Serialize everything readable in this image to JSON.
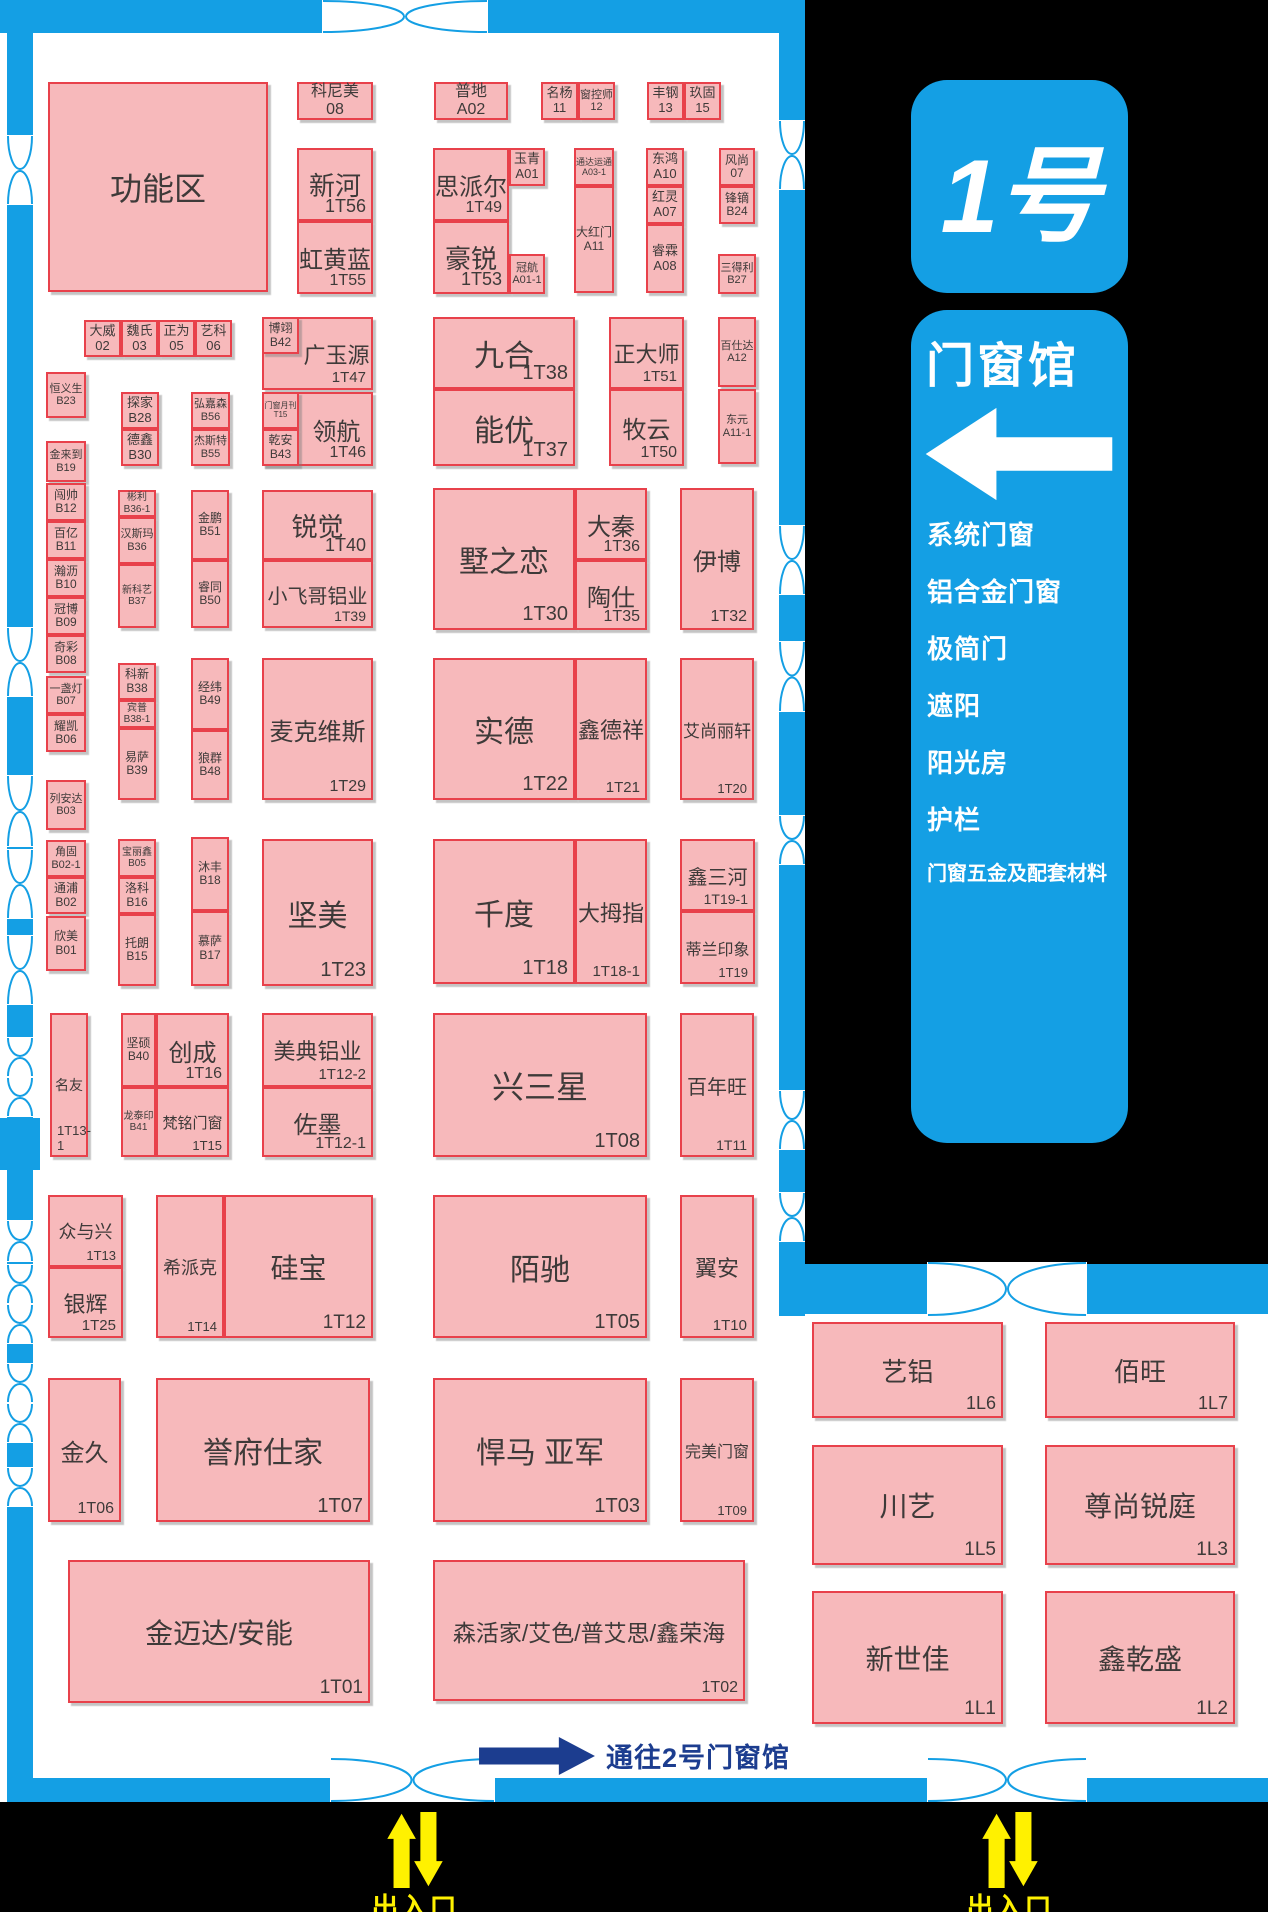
{
  "hall": {
    "badge": "1号",
    "name": "门窗馆"
  },
  "categories": [
    "系统门窗",
    "铝合金门窗",
    "极简门",
    "遮阳",
    "阳光房",
    "护栏",
    "门窗五金及配套材料"
  ],
  "signs": {
    "to_hall2": {
      "prefix": "通往",
      "number": "2",
      "suffix": "号门窗馆"
    },
    "entrance": "出入口"
  },
  "colors": {
    "wall": "#149FE4",
    "pink": "#F7B9BB",
    "red": "#E8414B",
    "dark": "#3E3A39",
    "navy": "#1C3D8F",
    "yellow": "#FFF100"
  },
  "booths": [
    {
      "n": "功能区",
      "no": "",
      "x": 48,
      "y": 82,
      "w": 220,
      "h": 210,
      "fs": 32,
      "m": "c"
    },
    {
      "n": "科尼美",
      "no": "08",
      "x": 297,
      "y": 82,
      "w": 76,
      "h": 38,
      "fs": 16,
      "m": "s"
    },
    {
      "n": "新河",
      "no": "1T56",
      "x": 297,
      "y": 148,
      "w": 76,
      "h": 73,
      "fs": 26,
      "m": "c"
    },
    {
      "n": "虹黄蓝",
      "no": "1T55",
      "x": 297,
      "y": 221,
      "w": 76,
      "h": 73,
      "fs": 24,
      "m": "c"
    },
    {
      "n": "普地",
      "no": "A02",
      "x": 434,
      "y": 82,
      "w": 74,
      "h": 38,
      "fs": 16,
      "m": "s"
    },
    {
      "n": "思派尔",
      "no": "1T49",
      "x": 433,
      "y": 148,
      "w": 76,
      "h": 73,
      "fs": 24,
      "m": "c"
    },
    {
      "n": "豪锐",
      "no": "1T53",
      "x": 433,
      "y": 221,
      "w": 76,
      "h": 73,
      "fs": 26,
      "m": "c"
    },
    {
      "n": "玉青",
      "no": "A01",
      "x": 509,
      "y": 148,
      "w": 36,
      "h": 38,
      "fs": 13,
      "m": "s"
    },
    {
      "n": "冠航",
      "no": "A01-1",
      "x": 509,
      "y": 254,
      "w": 36,
      "h": 40,
      "fs": 11,
      "m": "s"
    },
    {
      "n": "名杨",
      "no": "11",
      "x": 541,
      "y": 82,
      "w": 37,
      "h": 38,
      "fs": 13,
      "m": "s"
    },
    {
      "n": "窗控师",
      "no": "12",
      "x": 578,
      "y": 82,
      "w": 37,
      "h": 38,
      "fs": 11,
      "m": "s"
    },
    {
      "n": "通达运通",
      "no": "A03-1",
      "x": 574,
      "y": 148,
      "w": 40,
      "h": 38,
      "fs": 9,
      "m": "s"
    },
    {
      "n": "大红门",
      "no": "A11",
      "x": 574,
      "y": 186,
      "w": 40,
      "h": 107,
      "fs": 12,
      "m": "s"
    },
    {
      "n": "丰钢",
      "no": "13",
      "x": 647,
      "y": 82,
      "w": 37,
      "h": 38,
      "fs": 13,
      "m": "s"
    },
    {
      "n": "玖固",
      "no": "15",
      "x": 684,
      "y": 82,
      "w": 37,
      "h": 38,
      "fs": 13,
      "m": "s"
    },
    {
      "n": "东鸿",
      "no": "A10",
      "x": 646,
      "y": 148,
      "w": 38,
      "h": 38,
      "fs": 13,
      "m": "s"
    },
    {
      "n": "红灵",
      "no": "A07",
      "x": 646,
      "y": 186,
      "w": 38,
      "h": 38,
      "fs": 13,
      "m": "s"
    },
    {
      "n": "睿霖",
      "no": "A08",
      "x": 646,
      "y": 224,
      "w": 38,
      "h": 69,
      "fs": 13,
      "m": "s"
    },
    {
      "n": "风尚",
      "no": "07",
      "x": 719,
      "y": 148,
      "w": 36,
      "h": 38,
      "fs": 12,
      "m": "s"
    },
    {
      "n": "锋镝",
      "no": "B24",
      "x": 719,
      "y": 186,
      "w": 36,
      "h": 38,
      "fs": 12,
      "m": "s"
    },
    {
      "n": "三得利",
      "no": "B27",
      "x": 718,
      "y": 254,
      "w": 38,
      "h": 40,
      "fs": 11,
      "m": "s"
    },
    {
      "n": "大威",
      "no": "02",
      "x": 84,
      "y": 320,
      "w": 37,
      "h": 37,
      "fs": 13,
      "m": "s"
    },
    {
      "n": "魏氏",
      "no": "03",
      "x": 121,
      "y": 320,
      "w": 37,
      "h": 37,
      "fs": 13,
      "m": "s"
    },
    {
      "n": "正为",
      "no": "05",
      "x": 158,
      "y": 320,
      "w": 37,
      "h": 37,
      "fs": 13,
      "m": "s"
    },
    {
      "n": "艺科",
      "no": "06",
      "x": 195,
      "y": 320,
      "w": 37,
      "h": 37,
      "fs": 13,
      "m": "s"
    },
    {
      "n": "恒义生",
      "no": "B23",
      "x": 46,
      "y": 372,
      "w": 40,
      "h": 46,
      "fs": 11,
      "m": "s"
    },
    {
      "n": "探家",
      "no": "B28",
      "x": 121,
      "y": 392,
      "w": 38,
      "h": 37,
      "fs": 13,
      "m": "s"
    },
    {
      "n": "德鑫",
      "no": "B30",
      "x": 121,
      "y": 429,
      "w": 38,
      "h": 37,
      "fs": 13,
      "m": "s"
    },
    {
      "n": "弘嘉森",
      "no": "B56",
      "x": 191,
      "y": 392,
      "w": 39,
      "h": 37,
      "fs": 11,
      "m": "s"
    },
    {
      "n": "杰斯特",
      "no": "B55",
      "x": 191,
      "y": 429,
      "w": 39,
      "h": 37,
      "fs": 11,
      "m": "s"
    },
    {
      "n": "广玉源",
      "no": "1T47",
      "x": 262,
      "y": 317,
      "w": 111,
      "h": 73,
      "fs": 22,
      "m": "c",
      "pl": 38
    },
    {
      "n": "博翊",
      "no": "B42",
      "x": 262,
      "y": 317,
      "w": 37,
      "h": 37,
      "fs": 12,
      "m": "s"
    },
    {
      "n": "领航",
      "no": "1T46",
      "x": 262,
      "y": 392,
      "w": 111,
      "h": 74,
      "fs": 24,
      "m": "c",
      "pl": 38
    },
    {
      "n": "门窗月刊",
      "no": "T15",
      "x": 262,
      "y": 392,
      "w": 37,
      "h": 37,
      "fs": 8,
      "m": "s"
    },
    {
      "n": "乾安",
      "no": "B43",
      "x": 262,
      "y": 429,
      "w": 37,
      "h": 37,
      "fs": 12,
      "m": "s"
    },
    {
      "n": "九合",
      "no": "1T38",
      "x": 433,
      "y": 317,
      "w": 142,
      "h": 72,
      "fs": 30,
      "m": "c"
    },
    {
      "n": "能优",
      "no": "1T37",
      "x": 433,
      "y": 389,
      "w": 142,
      "h": 77,
      "fs": 30,
      "m": "c"
    },
    {
      "n": "正大师",
      "no": "1T51",
      "x": 609,
      "y": 317,
      "w": 75,
      "h": 72,
      "fs": 22,
      "m": "c"
    },
    {
      "n": "牧云",
      "no": "1T50",
      "x": 609,
      "y": 389,
      "w": 75,
      "h": 77,
      "fs": 24,
      "m": "c"
    },
    {
      "n": "百仕达",
      "no": "A12",
      "x": 718,
      "y": 317,
      "w": 38,
      "h": 70,
      "fs": 11,
      "m": "s"
    },
    {
      "n": "东元",
      "no": "A11-1",
      "x": 718,
      "y": 389,
      "w": 38,
      "h": 75,
      "fs": 11,
      "m": "s"
    },
    {
      "n": "金来到",
      "no": "B19",
      "x": 46,
      "y": 441,
      "w": 40,
      "h": 41,
      "fs": 11,
      "m": "s"
    },
    {
      "n": "闯帅",
      "no": "B12",
      "x": 46,
      "y": 483,
      "w": 40,
      "h": 38,
      "fs": 12,
      "m": "s"
    },
    {
      "n": "百亿",
      "no": "B11",
      "x": 46,
      "y": 521,
      "w": 40,
      "h": 38,
      "fs": 12,
      "m": "s"
    },
    {
      "n": "瀚沥",
      "no": "B10",
      "x": 46,
      "y": 559,
      "w": 40,
      "h": 38,
      "fs": 12,
      "m": "s"
    },
    {
      "n": "冠博",
      "no": "B09",
      "x": 46,
      "y": 597,
      "w": 40,
      "h": 38,
      "fs": 12,
      "m": "s"
    },
    {
      "n": "奇彩",
      "no": "B08",
      "x": 46,
      "y": 635,
      "w": 40,
      "h": 38,
      "fs": 12,
      "m": "s"
    },
    {
      "n": "一盏灯",
      "no": "B07",
      "x": 46,
      "y": 676,
      "w": 40,
      "h": 38,
      "fs": 11,
      "m": "s"
    },
    {
      "n": "耀凯",
      "no": "B06",
      "x": 46,
      "y": 714,
      "w": 40,
      "h": 38,
      "fs": 12,
      "m": "s"
    },
    {
      "n": "列安达",
      "no": "B03",
      "x": 46,
      "y": 780,
      "w": 40,
      "h": 50,
      "fs": 11,
      "m": "s"
    },
    {
      "n": "角固",
      "no": "B02-1",
      "x": 46,
      "y": 840,
      "w": 40,
      "h": 37,
      "fs": 11,
      "m": "s"
    },
    {
      "n": "通浦",
      "no": "B02",
      "x": 46,
      "y": 877,
      "w": 40,
      "h": 37,
      "fs": 12,
      "m": "s"
    },
    {
      "n": "欣美",
      "no": "B01",
      "x": 46,
      "y": 916,
      "w": 40,
      "h": 55,
      "fs": 12,
      "m": "s"
    },
    {
      "n": "彬利",
      "no": "B36-1",
      "x": 118,
      "y": 490,
      "w": 38,
      "h": 27,
      "fs": 10,
      "m": "s"
    },
    {
      "n": "汉斯玛",
      "no": "B36",
      "x": 118,
      "y": 517,
      "w": 38,
      "h": 47,
      "fs": 11,
      "m": "s"
    },
    {
      "n": "新科艺",
      "no": "B37",
      "x": 118,
      "y": 564,
      "w": 38,
      "h": 64,
      "fs": 10,
      "m": "s"
    },
    {
      "n": "金鹏",
      "no": "B51",
      "x": 191,
      "y": 490,
      "w": 38,
      "h": 70,
      "fs": 12,
      "m": "s"
    },
    {
      "n": "睿同",
      "no": "B50",
      "x": 191,
      "y": 560,
      "w": 38,
      "h": 68,
      "fs": 12,
      "m": "s"
    },
    {
      "n": "锐觉",
      "no": "1T40",
      "x": 262,
      "y": 490,
      "w": 111,
      "h": 70,
      "fs": 26,
      "m": "c"
    },
    {
      "n": "小飞哥铝业",
      "no": "1T39",
      "x": 262,
      "y": 560,
      "w": 111,
      "h": 68,
      "fs": 20,
      "m": "c"
    },
    {
      "n": "墅之恋",
      "no": "1T30",
      "x": 433,
      "y": 488,
      "w": 142,
      "h": 142,
      "fs": 30,
      "m": "c"
    },
    {
      "n": "大秦",
      "no": "1T36",
      "x": 575,
      "y": 488,
      "w": 72,
      "h": 72,
      "fs": 24,
      "m": "c"
    },
    {
      "n": "陶仕",
      "no": "1T35",
      "x": 575,
      "y": 560,
      "w": 72,
      "h": 70,
      "fs": 24,
      "m": "c"
    },
    {
      "n": "伊博",
      "no": "1T32",
      "x": 680,
      "y": 488,
      "w": 74,
      "h": 142,
      "fs": 24,
      "m": "c"
    },
    {
      "n": "科新",
      "no": "B38",
      "x": 118,
      "y": 663,
      "w": 38,
      "h": 37,
      "fs": 12,
      "m": "s"
    },
    {
      "n": "宾普",
      "no": "B38-1",
      "x": 118,
      "y": 700,
      "w": 38,
      "h": 28,
      "fs": 10,
      "m": "s"
    },
    {
      "n": "易萨",
      "no": "B39",
      "x": 118,
      "y": 728,
      "w": 38,
      "h": 72,
      "fs": 12,
      "m": "s"
    },
    {
      "n": "经纬",
      "no": "B49",
      "x": 191,
      "y": 658,
      "w": 38,
      "h": 72,
      "fs": 12,
      "m": "s"
    },
    {
      "n": "狼群",
      "no": "B48",
      "x": 191,
      "y": 730,
      "w": 38,
      "h": 70,
      "fs": 12,
      "m": "s"
    },
    {
      "n": "麦克维斯",
      "no": "1T29",
      "x": 262,
      "y": 658,
      "w": 111,
      "h": 142,
      "fs": 24,
      "m": "c"
    },
    {
      "n": "实德",
      "no": "1T22",
      "x": 433,
      "y": 658,
      "w": 142,
      "h": 142,
      "fs": 30,
      "m": "c"
    },
    {
      "n": "鑫德祥",
      "no": "1T21",
      "x": 575,
      "y": 658,
      "w": 72,
      "h": 142,
      "fs": 22,
      "m": "c"
    },
    {
      "n": "艾尚丽轩",
      "no": "1T20",
      "x": 680,
      "y": 658,
      "w": 74,
      "h": 142,
      "fs": 17,
      "m": "c"
    },
    {
      "n": "宝丽鑫",
      "no": "B05",
      "x": 118,
      "y": 839,
      "w": 38,
      "h": 38,
      "fs": 10,
      "m": "s"
    },
    {
      "n": "洛科",
      "no": "B16",
      "x": 118,
      "y": 877,
      "w": 38,
      "h": 37,
      "fs": 12,
      "m": "s"
    },
    {
      "n": "托朗",
      "no": "B15",
      "x": 118,
      "y": 914,
      "w": 38,
      "h": 72,
      "fs": 12,
      "m": "s"
    },
    {
      "n": "沐丰",
      "no": "B18",
      "x": 191,
      "y": 837,
      "w": 38,
      "h": 74,
      "fs": 12,
      "m": "s"
    },
    {
      "n": "慕萨",
      "no": "B17",
      "x": 191,
      "y": 911,
      "w": 38,
      "h": 75,
      "fs": 12,
      "m": "s"
    },
    {
      "n": "坚美",
      "no": "1T23",
      "x": 262,
      "y": 839,
      "w": 111,
      "h": 147,
      "fs": 30,
      "m": "c"
    },
    {
      "n": "千度",
      "no": "1T18",
      "x": 433,
      "y": 839,
      "w": 142,
      "h": 145,
      "fs": 30,
      "m": "c"
    },
    {
      "n": "大拇指",
      "no": "1T18-1",
      "x": 575,
      "y": 839,
      "w": 72,
      "h": 145,
      "fs": 22,
      "m": "c"
    },
    {
      "n": "鑫三河",
      "no": "1T19-1",
      "x": 680,
      "y": 839,
      "w": 75,
      "h": 72,
      "fs": 20,
      "m": "c"
    },
    {
      "n": "蒂兰印象",
      "no": "1T19",
      "x": 680,
      "y": 911,
      "w": 75,
      "h": 73,
      "fs": 16,
      "m": "c"
    },
    {
      "n": "名友",
      "no": "1T13-1",
      "x": 50,
      "y": 1013,
      "w": 38,
      "h": 144,
      "fs": 14,
      "m": "c",
      "np": "bl"
    },
    {
      "n": "坚硕",
      "no": "B40",
      "x": 121,
      "y": 1013,
      "w": 35,
      "h": 74,
      "fs": 12,
      "m": "s"
    },
    {
      "n": "创成",
      "no": "1T16",
      "x": 156,
      "y": 1013,
      "w": 73,
      "h": 74,
      "fs": 24,
      "m": "c"
    },
    {
      "n": "龙泰印",
      "no": "B41",
      "x": 121,
      "y": 1087,
      "w": 35,
      "h": 70,
      "fs": 10,
      "m": "s"
    },
    {
      "n": "梵铭门窗",
      "no": "1T15",
      "x": 156,
      "y": 1087,
      "w": 73,
      "h": 70,
      "fs": 15,
      "m": "c"
    },
    {
      "n": "美典铝业",
      "no": "1T12-2",
      "x": 262,
      "y": 1013,
      "w": 111,
      "h": 74,
      "fs": 22,
      "m": "c"
    },
    {
      "n": "佐墨",
      "no": "1T12-1",
      "x": 262,
      "y": 1087,
      "w": 111,
      "h": 70,
      "fs": 24,
      "m": "c"
    },
    {
      "n": "兴三星",
      "no": "1T08",
      "x": 433,
      "y": 1013,
      "w": 214,
      "h": 144,
      "fs": 32,
      "m": "c"
    },
    {
      "n": "百年旺",
      "no": "1T11",
      "x": 680,
      "y": 1013,
      "w": 74,
      "h": 144,
      "fs": 20,
      "m": "c"
    },
    {
      "n": "众与兴",
      "no": "1T13",
      "x": 48,
      "y": 1195,
      "w": 75,
      "h": 72,
      "fs": 18,
      "m": "c"
    },
    {
      "n": "银辉",
      "no": "1T25",
      "x": 48,
      "y": 1267,
      "w": 75,
      "h": 71,
      "fs": 22,
      "m": "c"
    },
    {
      "n": "希派克",
      "no": "1T14",
      "x": 156,
      "y": 1195,
      "w": 68,
      "h": 143,
      "fs": 18,
      "m": "c"
    },
    {
      "n": "硅宝",
      "no": "1T12",
      "x": 224,
      "y": 1195,
      "w": 149,
      "h": 143,
      "fs": 28,
      "m": "c"
    },
    {
      "n": "陌驰",
      "no": "1T05",
      "x": 433,
      "y": 1195,
      "w": 214,
      "h": 143,
      "fs": 30,
      "m": "c"
    },
    {
      "n": "翼安",
      "no": "1T10",
      "x": 680,
      "y": 1195,
      "w": 74,
      "h": 143,
      "fs": 22,
      "m": "c"
    },
    {
      "n": "金久",
      "no": "1T06",
      "x": 48,
      "y": 1378,
      "w": 73,
      "h": 144,
      "fs": 24,
      "m": "c"
    },
    {
      "n": "誉府仕家",
      "no": "1T07",
      "x": 156,
      "y": 1378,
      "w": 214,
      "h": 144,
      "fs": 30,
      "m": "c"
    },
    {
      "n": "悍马 亚军",
      "no": "1T03",
      "x": 433,
      "y": 1378,
      "w": 214,
      "h": 144,
      "fs": 30,
      "m": "c"
    },
    {
      "n": "完美门窗",
      "no": "1T09",
      "x": 680,
      "y": 1378,
      "w": 74,
      "h": 144,
      "fs": 16,
      "m": "c"
    },
    {
      "n": "金迈达/安能",
      "no": "1T01",
      "x": 68,
      "y": 1560,
      "w": 302,
      "h": 143,
      "fs": 28,
      "m": "c"
    },
    {
      "n": "森活家/艾色/普艾思/鑫荣海",
      "no": "1T02",
      "x": 433,
      "y": 1560,
      "w": 312,
      "h": 141,
      "fs": 23,
      "m": "c"
    },
    {
      "n": "艺铝",
      "no": "1L6",
      "x": 812,
      "y": 1322,
      "w": 191,
      "h": 96,
      "fs": 26,
      "m": "c"
    },
    {
      "n": "佰旺",
      "no": "1L7",
      "x": 1045,
      "y": 1322,
      "w": 190,
      "h": 96,
      "fs": 26,
      "m": "c"
    },
    {
      "n": "川艺",
      "no": "1L5",
      "x": 812,
      "y": 1445,
      "w": 191,
      "h": 120,
      "fs": 28,
      "m": "c"
    },
    {
      "n": "尊尚锐庭",
      "no": "1L3",
      "x": 1045,
      "y": 1445,
      "w": 190,
      "h": 120,
      "fs": 28,
      "m": "c"
    },
    {
      "n": "新世佳",
      "no": "1L1",
      "x": 812,
      "y": 1591,
      "w": 191,
      "h": 133,
      "fs": 28,
      "m": "c"
    },
    {
      "n": "鑫乾盛",
      "no": "1L2",
      "x": 1045,
      "y": 1591,
      "w": 190,
      "h": 133,
      "fs": 28,
      "m": "c"
    }
  ]
}
